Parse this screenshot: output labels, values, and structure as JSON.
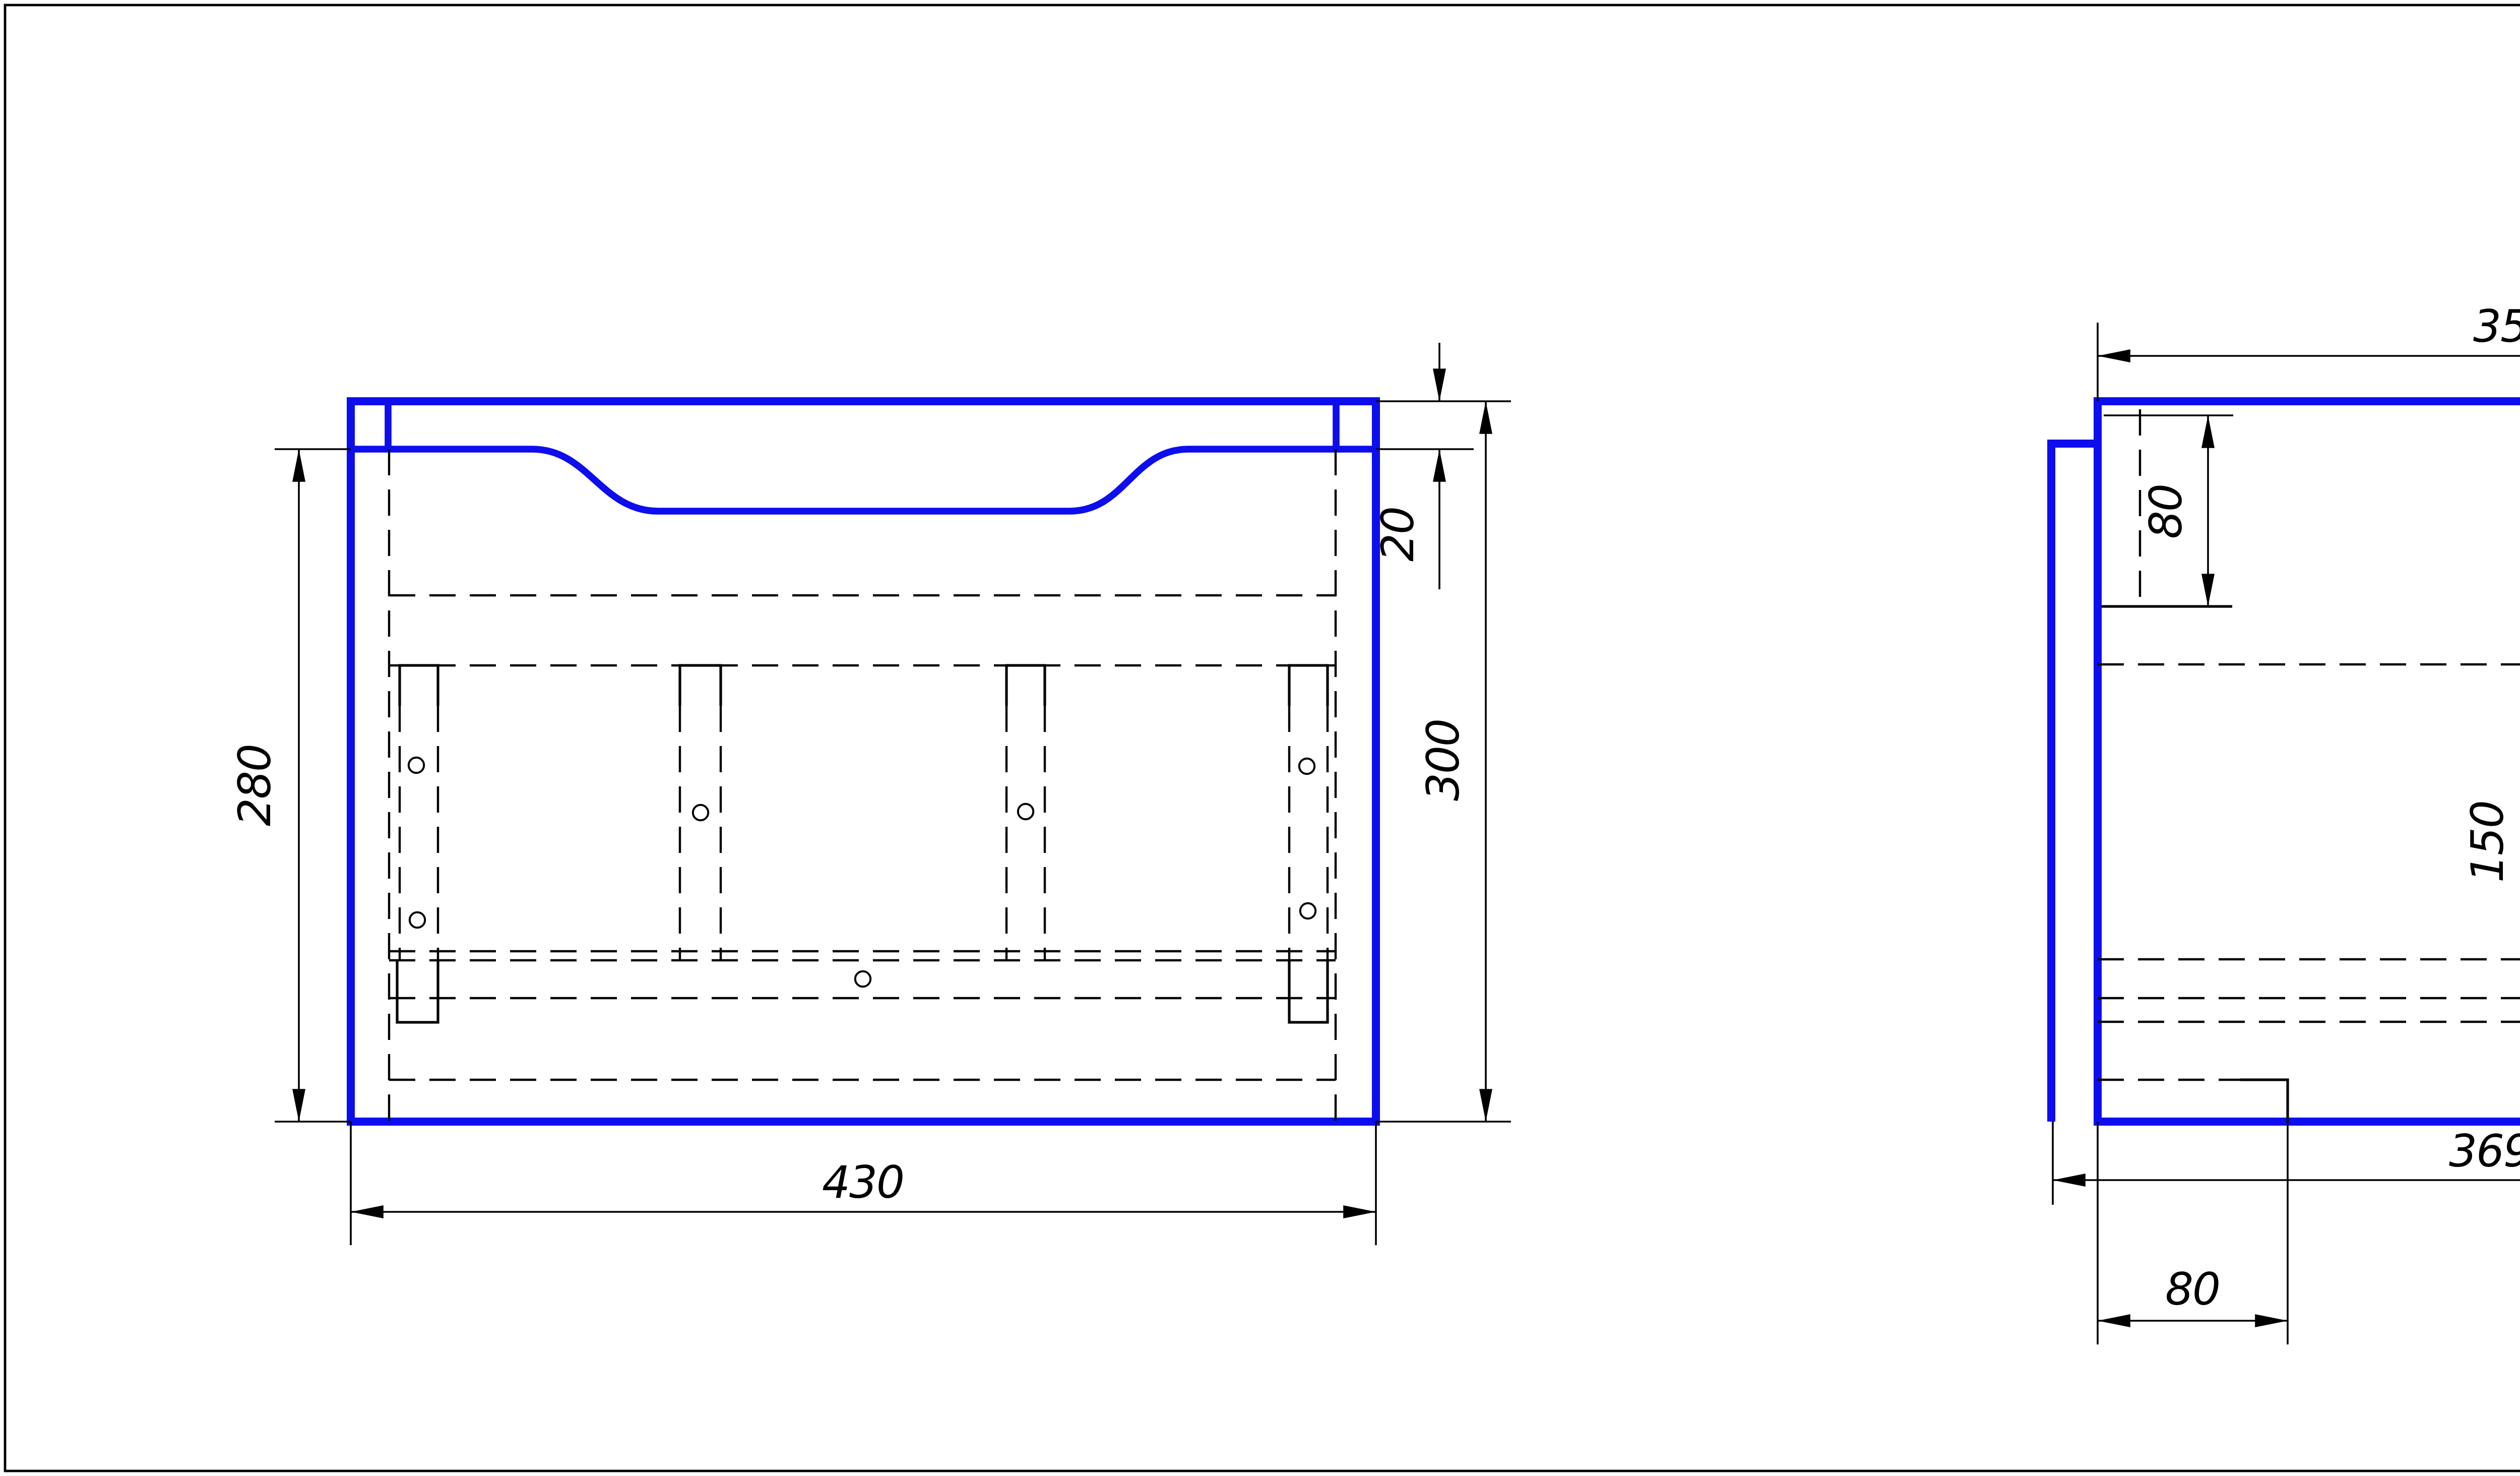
{
  "sheet": {
    "background": "#ffffff",
    "part_line_color": "#0d0dee",
    "annotation_color": "#000000"
  },
  "views": {
    "front": {
      "label": "front-view"
    },
    "side": {
      "label": "side-view"
    }
  },
  "dims": {
    "front": {
      "width": "430",
      "opening_height": "280",
      "top_rail": "20",
      "height": "300"
    },
    "side": {
      "top_width": "350",
      "rail_depth": "80",
      "upper_gap": "110",
      "middle_gap": "120",
      "drawer_height": "150",
      "height": "300",
      "bottom_width": "369",
      "bottom_inset": "80"
    }
  }
}
